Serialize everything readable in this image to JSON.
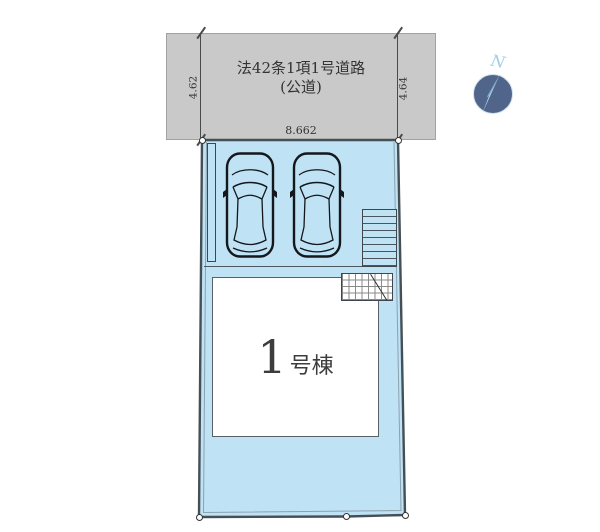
{
  "plan": {
    "road": {
      "name": "法42条1項1号道路",
      "type": "(公道)",
      "frontage_width": "8.662",
      "side_left": "4.62",
      "side_right": "4.64"
    },
    "building": {
      "number": "1",
      "label": "号棟"
    },
    "compass": {
      "north": "N"
    },
    "colors": {
      "road_fill": "#c9c9c9",
      "lot_fill": "#bfe2f4",
      "lot_border": "#454f56",
      "building_fill": "#ffffff",
      "line": "#4a4a4a",
      "text": "#333333",
      "compass_circle": "#51658b",
      "compass_needle": "#b9ddf1",
      "compass_text": "#9fcfe9"
    }
  }
}
